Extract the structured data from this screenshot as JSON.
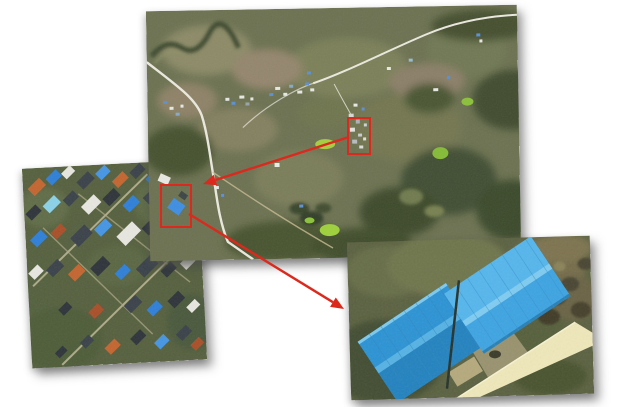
{
  "figure": {
    "kind": "satellite-zoom-figure",
    "background_color": "#ffffff",
    "annotation_color": "#dc291d",
    "panels": [
      {
        "id": "overview",
        "name": "overview-satellite-image",
        "left": 148,
        "top": 8,
        "width": 371,
        "height": 250,
        "rotation": -1,
        "z": 2
      },
      {
        "id": "village",
        "name": "village-zoom-inset",
        "left": 27,
        "top": 164,
        "width": 175,
        "height": 200,
        "rotation": -3,
        "z": 1
      },
      {
        "id": "warehouse",
        "name": "warehouse-zoom-inset",
        "left": 349,
        "top": 239,
        "width": 243,
        "height": 158,
        "rotation": -1.6,
        "z": 3
      }
    ],
    "highlight_boxes": [
      {
        "id": "box-building-cluster",
        "left": 347,
        "top": 117,
        "width": 20,
        "height": 34,
        "links_to": "village"
      },
      {
        "id": "box-blue-roof-building",
        "left": 160,
        "top": 184,
        "width": 28,
        "height": 40,
        "links_to": "warehouse"
      }
    ],
    "arrows": [
      {
        "id": "arrow-cluster-to-village",
        "from": [
          349,
          137
        ],
        "to": [
          203,
          184
        ]
      },
      {
        "id": "arrow-building-to-warehouse",
        "from": [
          189,
          214
        ],
        "to": [
          344,
          309
        ]
      }
    ],
    "palette": {
      "warehouse_roof_blue": "#2f9ddd",
      "village_roof_blue": "#2f7fd8",
      "roof_orange": "#c4652f",
      "road_light": "#eceadf",
      "road_yellow": "#f0e9bb",
      "terrain_olive": "#6b7150",
      "terrain_dark_green": "#414e2e"
    }
  }
}
